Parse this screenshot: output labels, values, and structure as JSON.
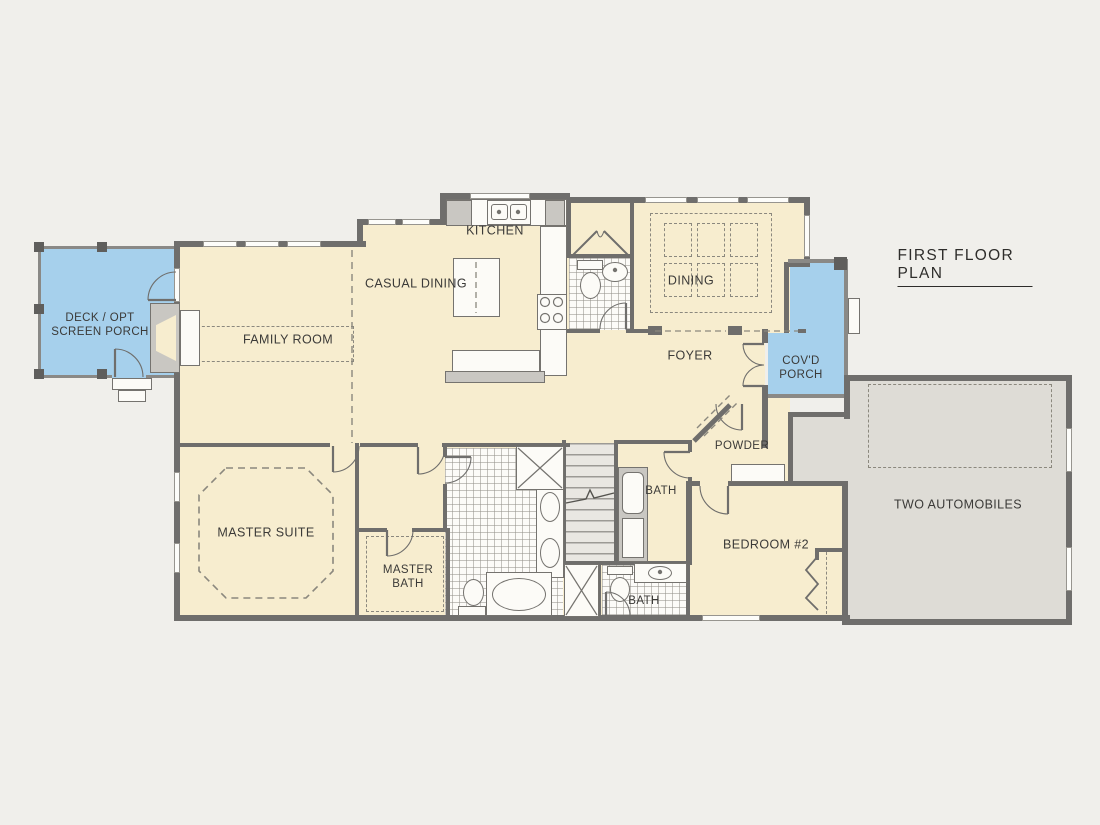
{
  "title": "FIRST FLOOR PLAN",
  "rooms": {
    "kitchen": "KITCHEN",
    "casual_dining": "CASUAL DINING",
    "family_room": "FAMILY ROOM",
    "deck": "DECK / OPT\nSCREEN PORCH",
    "dining": "DINING",
    "foyer": "FOYER",
    "covd_porch": "COV'D\nPORCH",
    "powder": "POWDER",
    "bath_upper": "BATH",
    "bath_lower": "BATH",
    "master_suite": "MASTER SUITE",
    "master_bath": "MASTER\nBATH",
    "bedroom_2": "BEDROOM #2",
    "garage": "TWO AUTOMOBILES"
  },
  "colors": {
    "background": "#f0efeb",
    "wall": "#6f6e6c",
    "room_fill": "#f7edcf",
    "porch_fill": "#a6d0ec",
    "garage_fill": "#dedcd6",
    "label_ink": "#3b3a38",
    "dash_line": "#8b887e",
    "fixture_white": "#fcfbf7",
    "fixture_gray": "#c9c7c2"
  }
}
